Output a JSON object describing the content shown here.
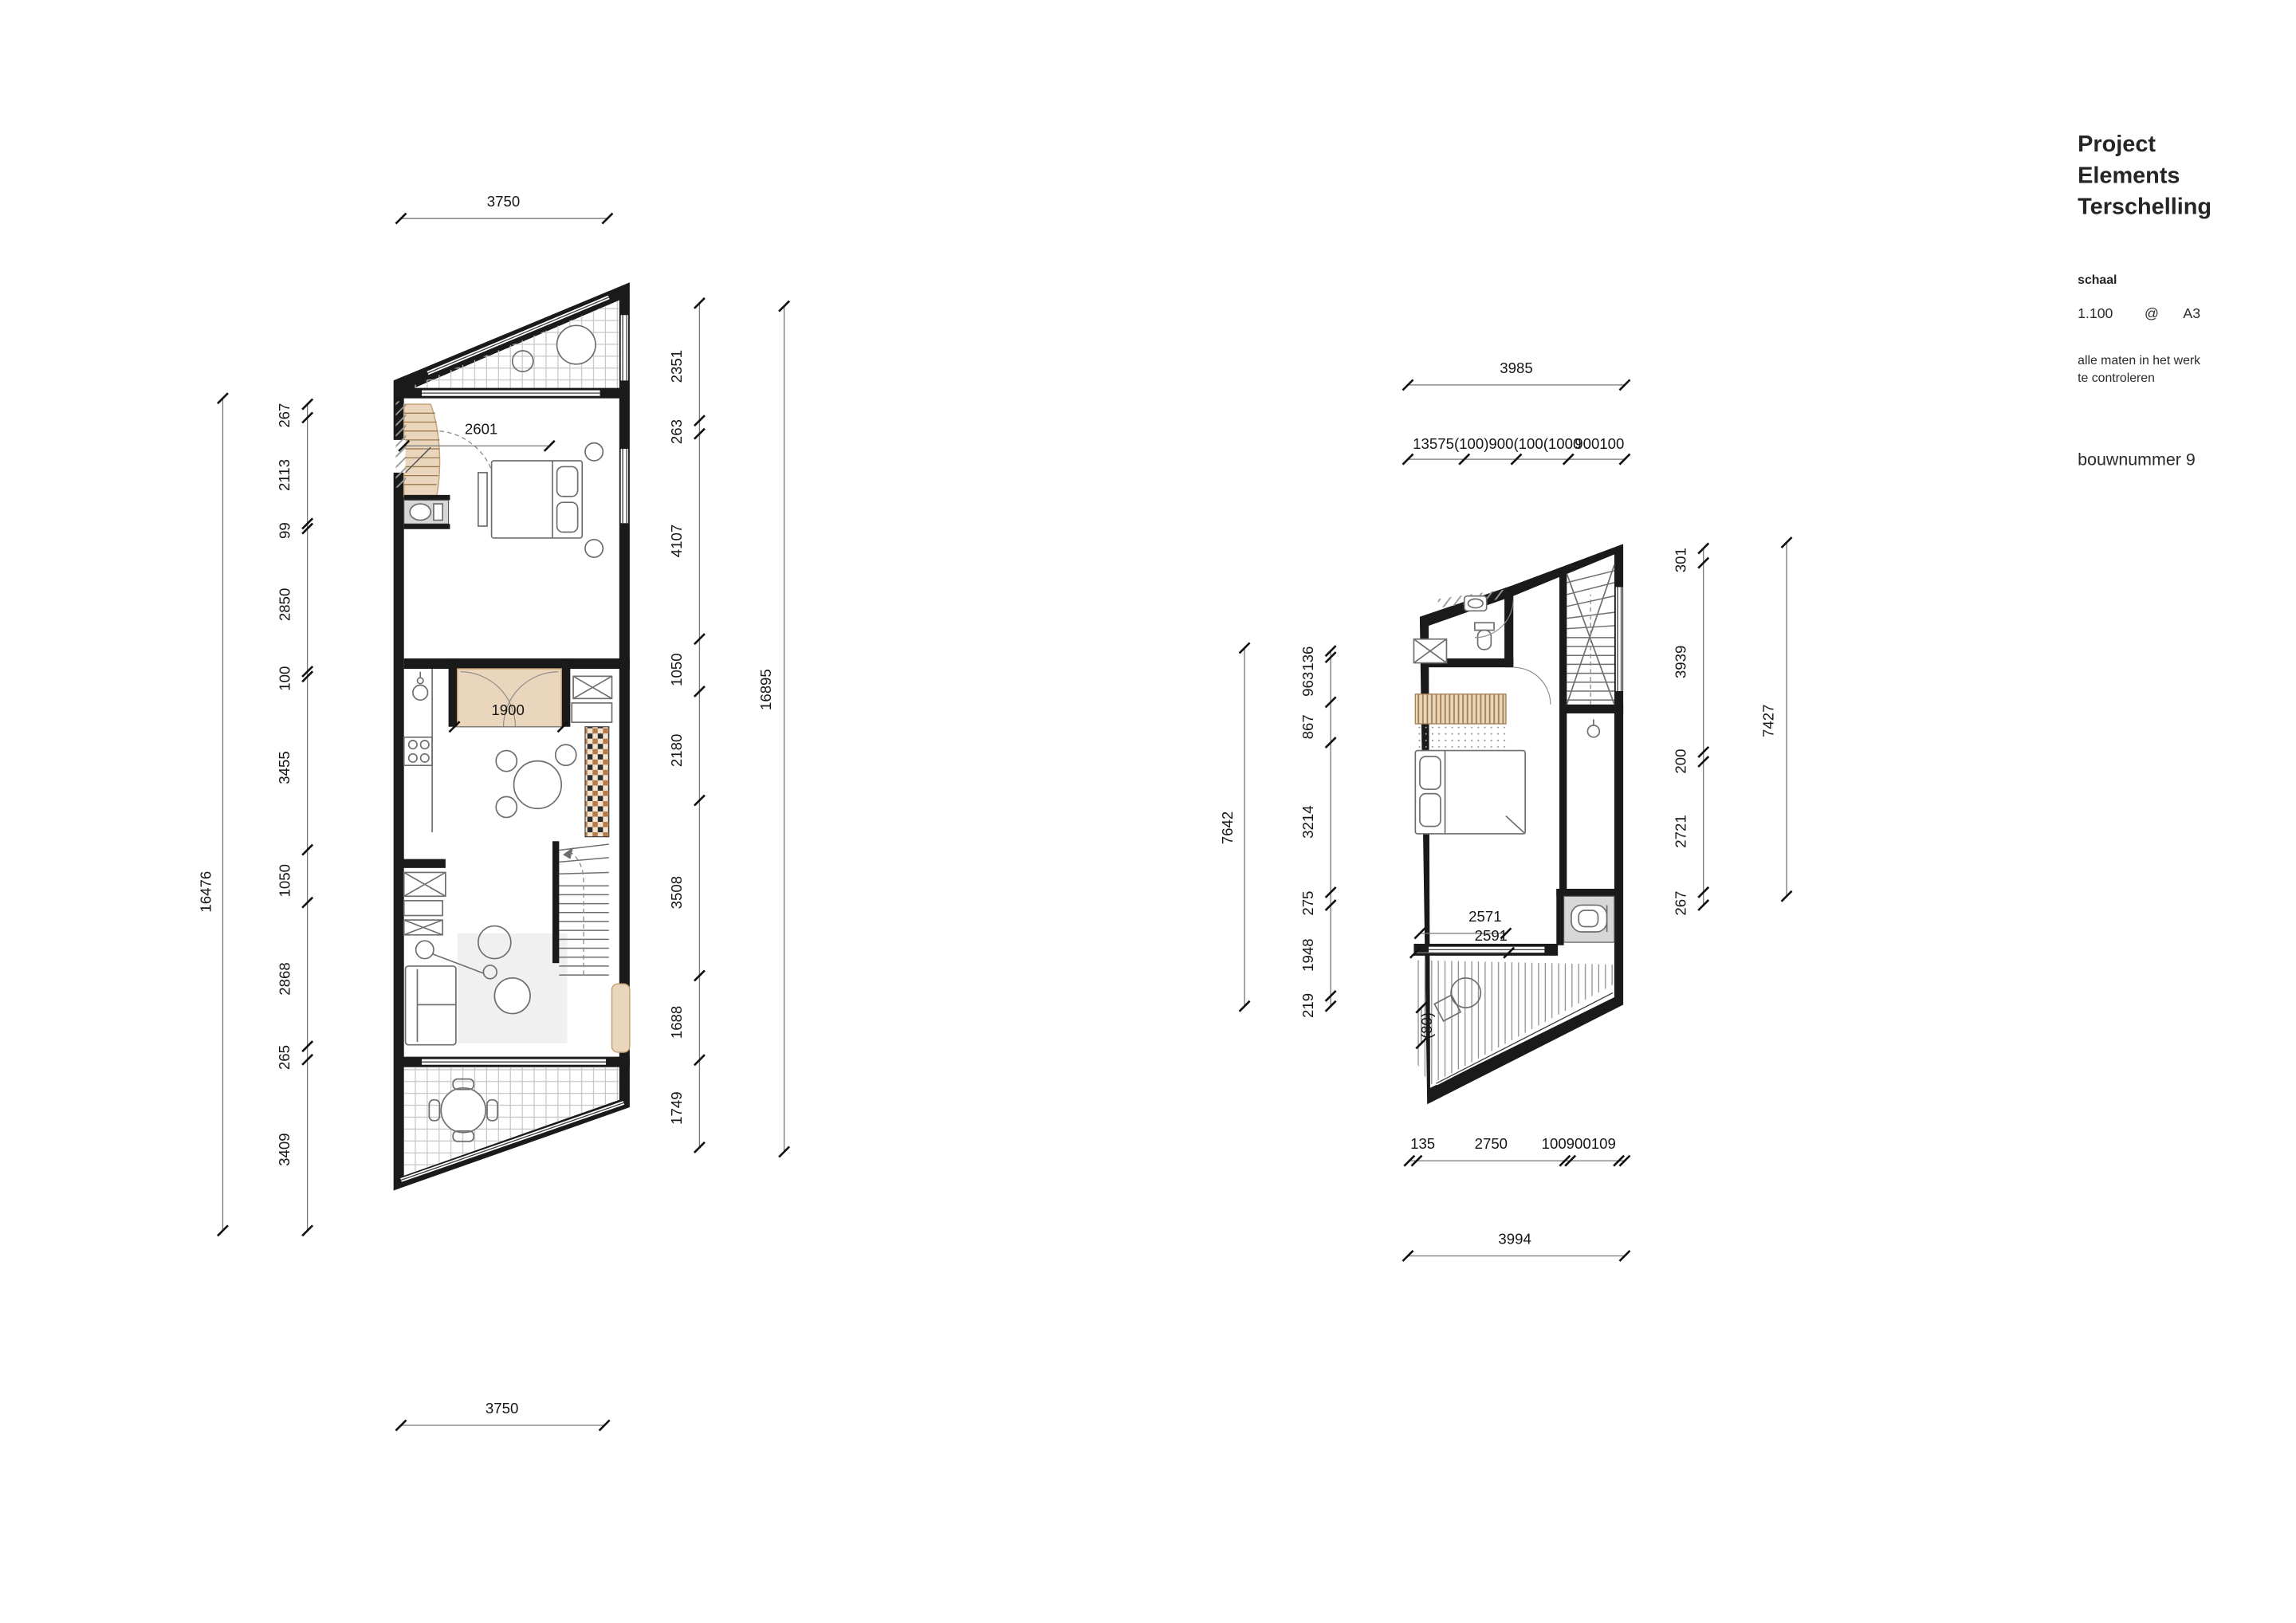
{
  "title_block": {
    "project_line1": "Project",
    "project_line2": "Elements",
    "project_line3": "Terschelling",
    "schaal_label": "schaal",
    "scale_value": "1.100",
    "at_symbol": "@",
    "paper_size": "A3",
    "note_line1": "alle maten in het werk",
    "note_line2": "te controleren",
    "bouwnummer": "bouwnummer 9"
  },
  "plans": {
    "ground": {
      "top_dim": "3750",
      "bottom_dim": "3750",
      "left_overall": "16476",
      "right_overall": "16895",
      "left_chain": [
        "267",
        "2113",
        "99",
        "2850",
        "100",
        "3455",
        "1050",
        "2868",
        "265",
        "3409"
      ],
      "right_chain": [
        "2351",
        "263",
        "4107",
        "1050",
        "2180",
        "3508",
        "1688",
        "1749"
      ],
      "inner_dims": [
        "2601",
        "1900"
      ]
    },
    "upper": {
      "top_dim": "3985",
      "top_chain": [
        "13575(100)900(100(1000",
        "900100"
      ],
      "bottom_chain": [
        "135",
        "2750",
        "100900109"
      ],
      "bottom_overall": "3994",
      "left_overall": "7642",
      "right_overall": "7427",
      "left_chain": [
        "136",
        "963",
        "867",
        "3214",
        "275",
        "1948",
        "219"
      ],
      "right_chain": [
        "301",
        "3939",
        "200",
        "2721",
        "267"
      ],
      "inner_dims": [
        "2571",
        "2591",
        "(80)"
      ]
    }
  }
}
